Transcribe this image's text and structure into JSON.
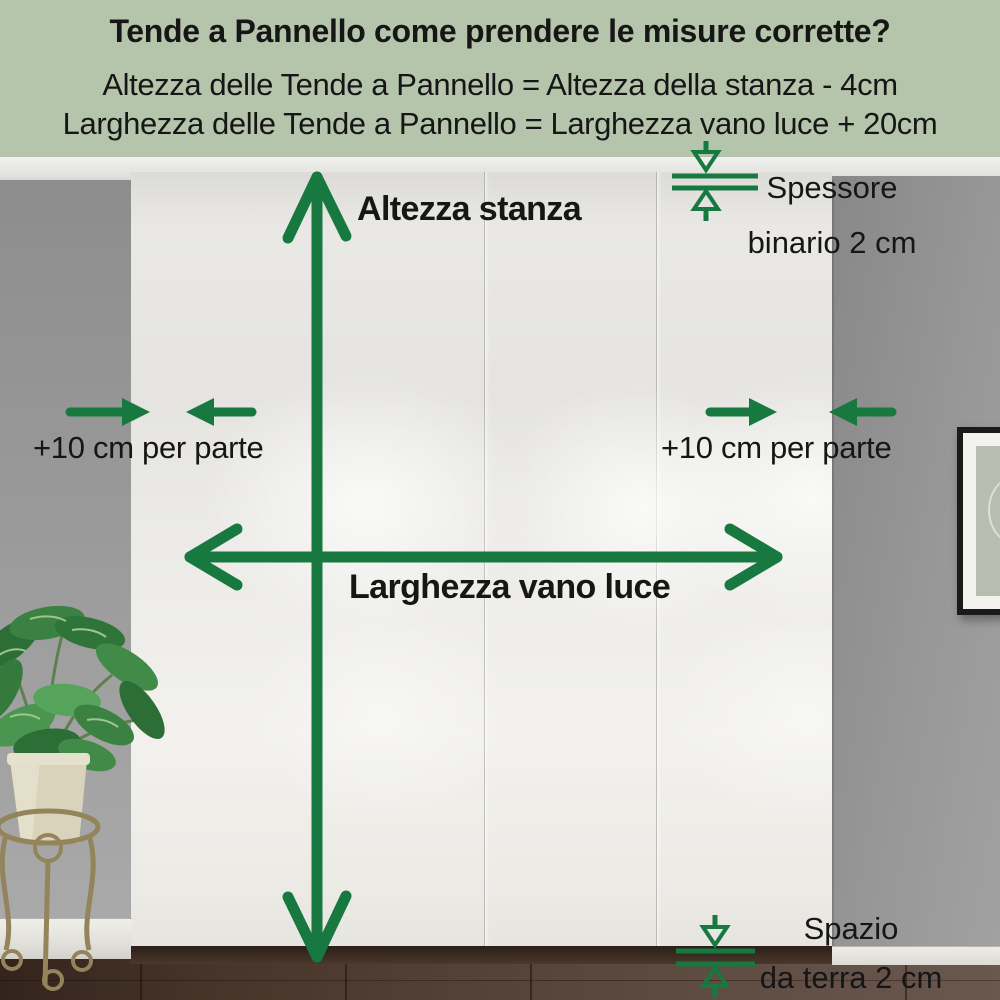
{
  "header": {
    "title": "Tende a Pannello come prendere le misure corrette?",
    "formula_height": "Altezza delle Tende a Pannello = Altezza della stanza - 4cm",
    "formula_width": "Larghezza delle Tende a Pannello = Larghezza vano luce + 20cm"
  },
  "labels": {
    "room_height": "Altezza stanza",
    "window_width": "Larghezza vano luce",
    "side_margin_left": "+10 cm per parte",
    "side_margin_right": "+10 cm per parte",
    "rail_line1": "Spessore",
    "rail_line2": "binario 2 cm",
    "floor_gap_line1": "Spazio",
    "floor_gap_line2": "da terra 2 cm"
  },
  "colors": {
    "accent_green": "#17793f",
    "header_background": "#b5c5ab",
    "text": "#161616"
  }
}
